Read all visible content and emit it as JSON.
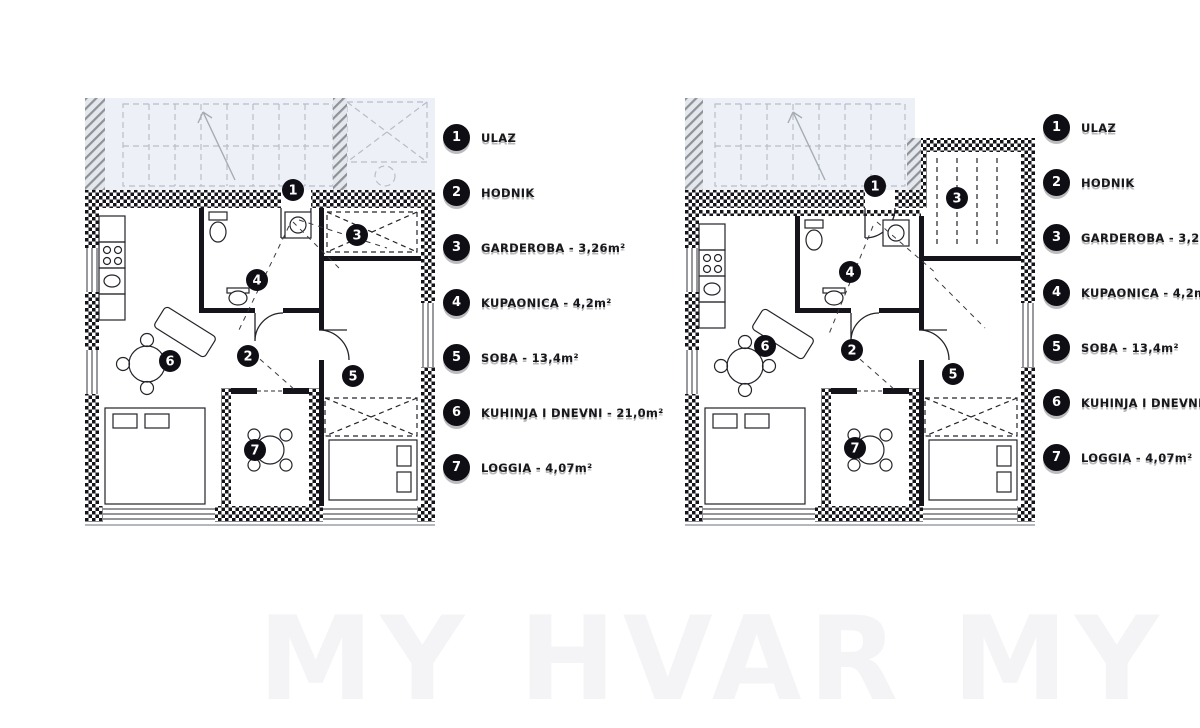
{
  "page": {
    "watermark_text": "MY HVAR MY HVAR",
    "colors": {
      "wall_black": "#14141a",
      "neighbor_gray": "#b9bdc6",
      "upper_tint": "#edf1f7",
      "badge_black": "#0e0e14",
      "watermark_tint": "#3c3c6e"
    }
  },
  "legend_left": {
    "items": [
      {
        "num": "1",
        "label": "ULAZ"
      },
      {
        "num": "2",
        "label": "HODNIK"
      },
      {
        "num": "3",
        "label": "GARDEROBA - 3,26m²"
      },
      {
        "num": "4",
        "label": "KUPAONICA - 4,2m²"
      },
      {
        "num": "5",
        "label": "SOBA - 13,4m²"
      },
      {
        "num": "6",
        "label": "KUHINJA I DNEVNI - 21,0m²"
      },
      {
        "num": "7",
        "label": "LOGGIA - 4,07m²"
      }
    ]
  },
  "legend_right": {
    "items": [
      {
        "num": "1",
        "label": "ULAZ"
      },
      {
        "num": "2",
        "label": "HODNIK"
      },
      {
        "num": "3",
        "label": "GARDEROBA - 3,26m²"
      },
      {
        "num": "4",
        "label": "KUPAONICA - 4,2m²"
      },
      {
        "num": "5",
        "label": "SOBA - 13,4m²"
      },
      {
        "num": "6",
        "label": "KUHINJA I DNEVNI - 21,0m²"
      },
      {
        "num": "7",
        "label": "LOGGIA - 4,07m²"
      }
    ]
  },
  "plans": {
    "left": {
      "markers": [
        {
          "num": "1",
          "x": 208,
          "y": 92
        },
        {
          "num": "2",
          "x": 163,
          "y": 258
        },
        {
          "num": "3",
          "x": 272,
          "y": 137
        },
        {
          "num": "4",
          "x": 172,
          "y": 182
        },
        {
          "num": "5",
          "x": 268,
          "y": 278
        },
        {
          "num": "6",
          "x": 85,
          "y": 263
        },
        {
          "num": "7",
          "x": 170,
          "y": 352
        }
      ]
    },
    "right": {
      "markers": [
        {
          "num": "1",
          "x": 190,
          "y": 88
        },
        {
          "num": "2",
          "x": 167,
          "y": 252
        },
        {
          "num": "3",
          "x": 272,
          "y": 100
        },
        {
          "num": "4",
          "x": 165,
          "y": 174
        },
        {
          "num": "5",
          "x": 268,
          "y": 276
        },
        {
          "num": "6",
          "x": 80,
          "y": 248
        },
        {
          "num": "7",
          "x": 170,
          "y": 350
        }
      ]
    }
  }
}
